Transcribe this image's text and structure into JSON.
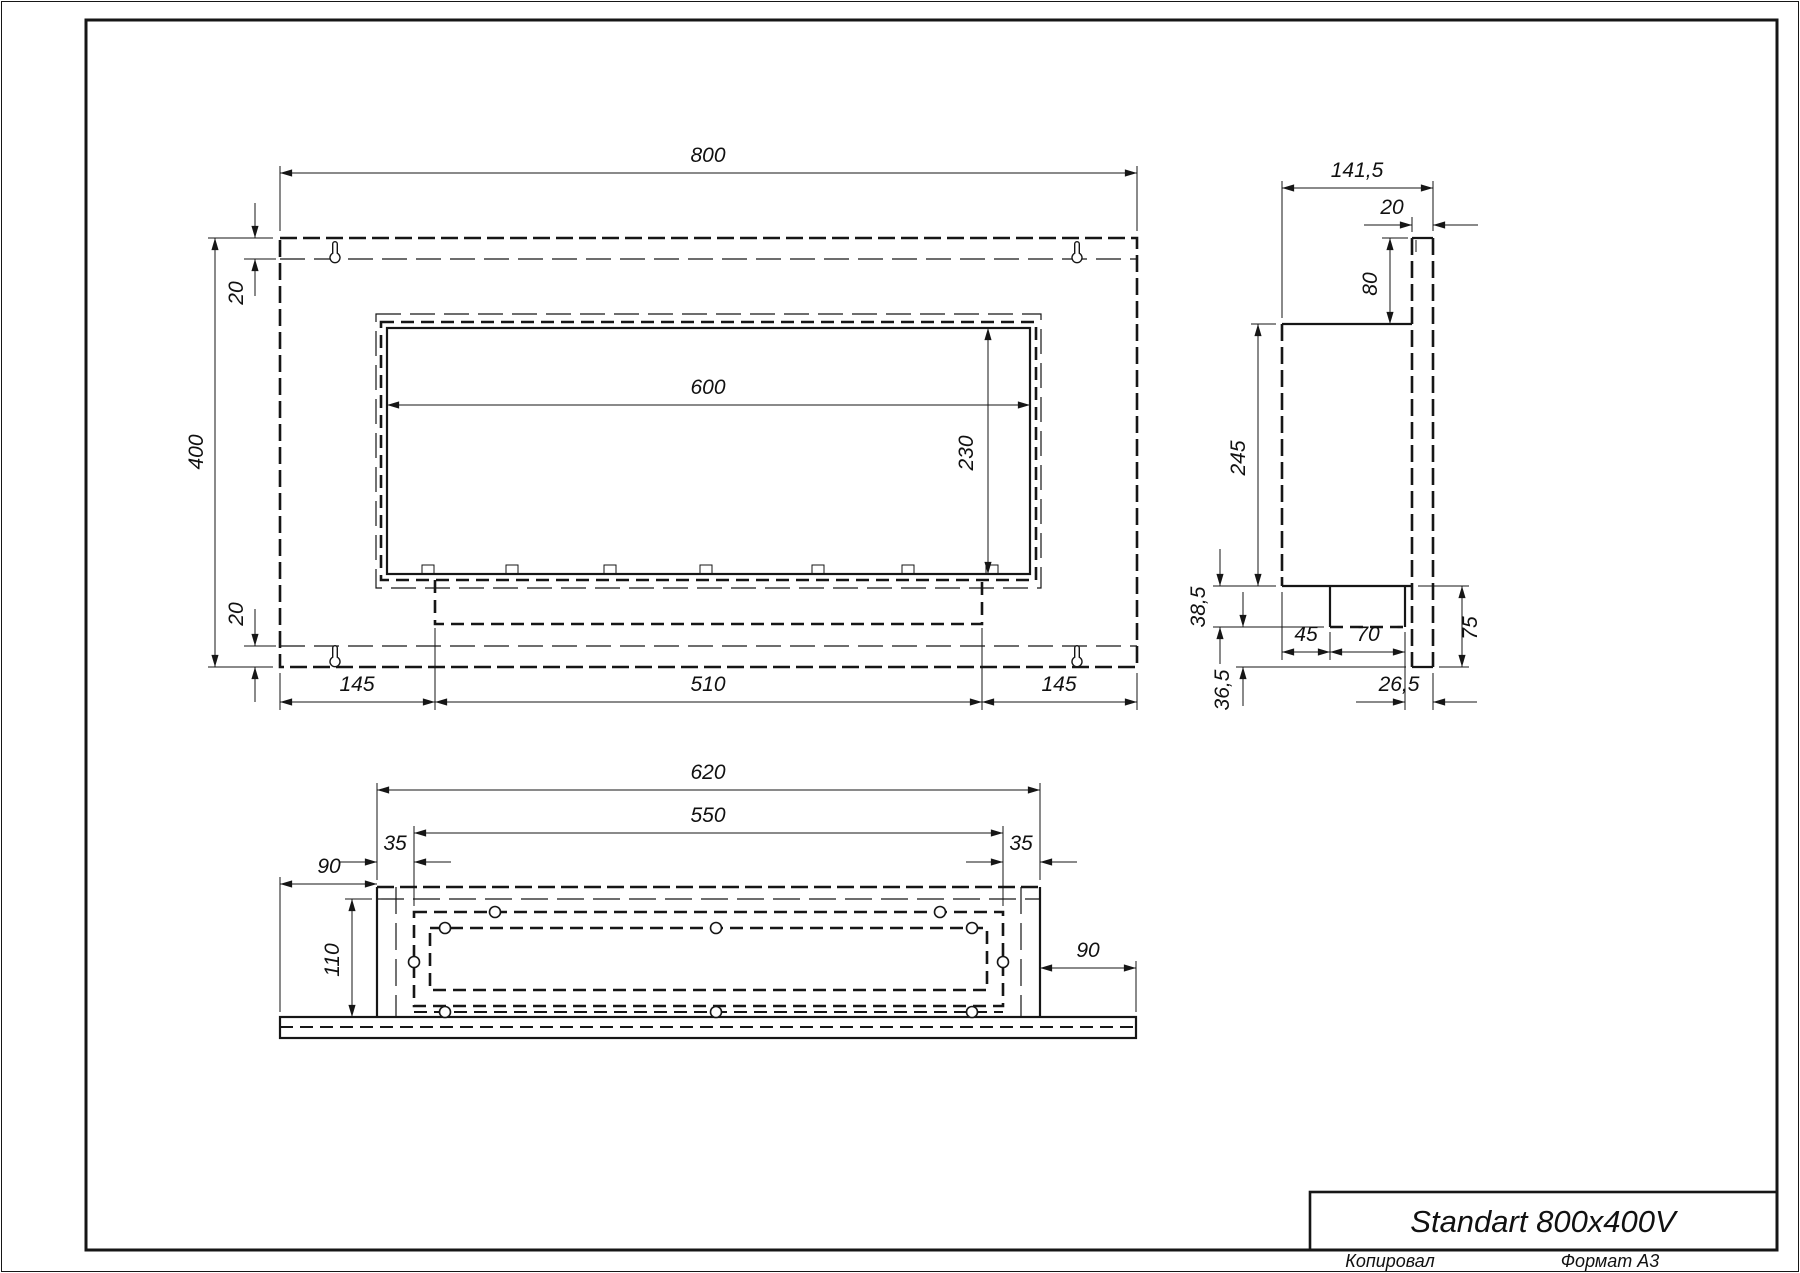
{
  "title_block": {
    "title": "Standart 800x400V",
    "copied": "Копировал",
    "format": "Формат А3"
  },
  "front_view": {
    "dims": {
      "width": "800",
      "height": "400",
      "top_flange": "20",
      "bottom_flange": "20",
      "opening_width": "600",
      "opening_height": "230",
      "side_left": "145",
      "tray": "510",
      "side_right": "145"
    }
  },
  "side_view": {
    "dims": {
      "depth": "141,5",
      "plate_thickness": "20",
      "plate_above_body": "80",
      "body_height": "245",
      "under_body": "38,5",
      "under_tray": "36,5",
      "front_to_tray": "45",
      "tray_depth": "70",
      "plate_below_body": "75",
      "tray_to_back": "26,5"
    }
  },
  "bottom_view": {
    "dims": {
      "body_width": "620",
      "tray_width": "550",
      "inset_left": "35",
      "inset_right": "35",
      "overhang_left": "90",
      "overhang_right": "90",
      "depth": "110"
    }
  }
}
